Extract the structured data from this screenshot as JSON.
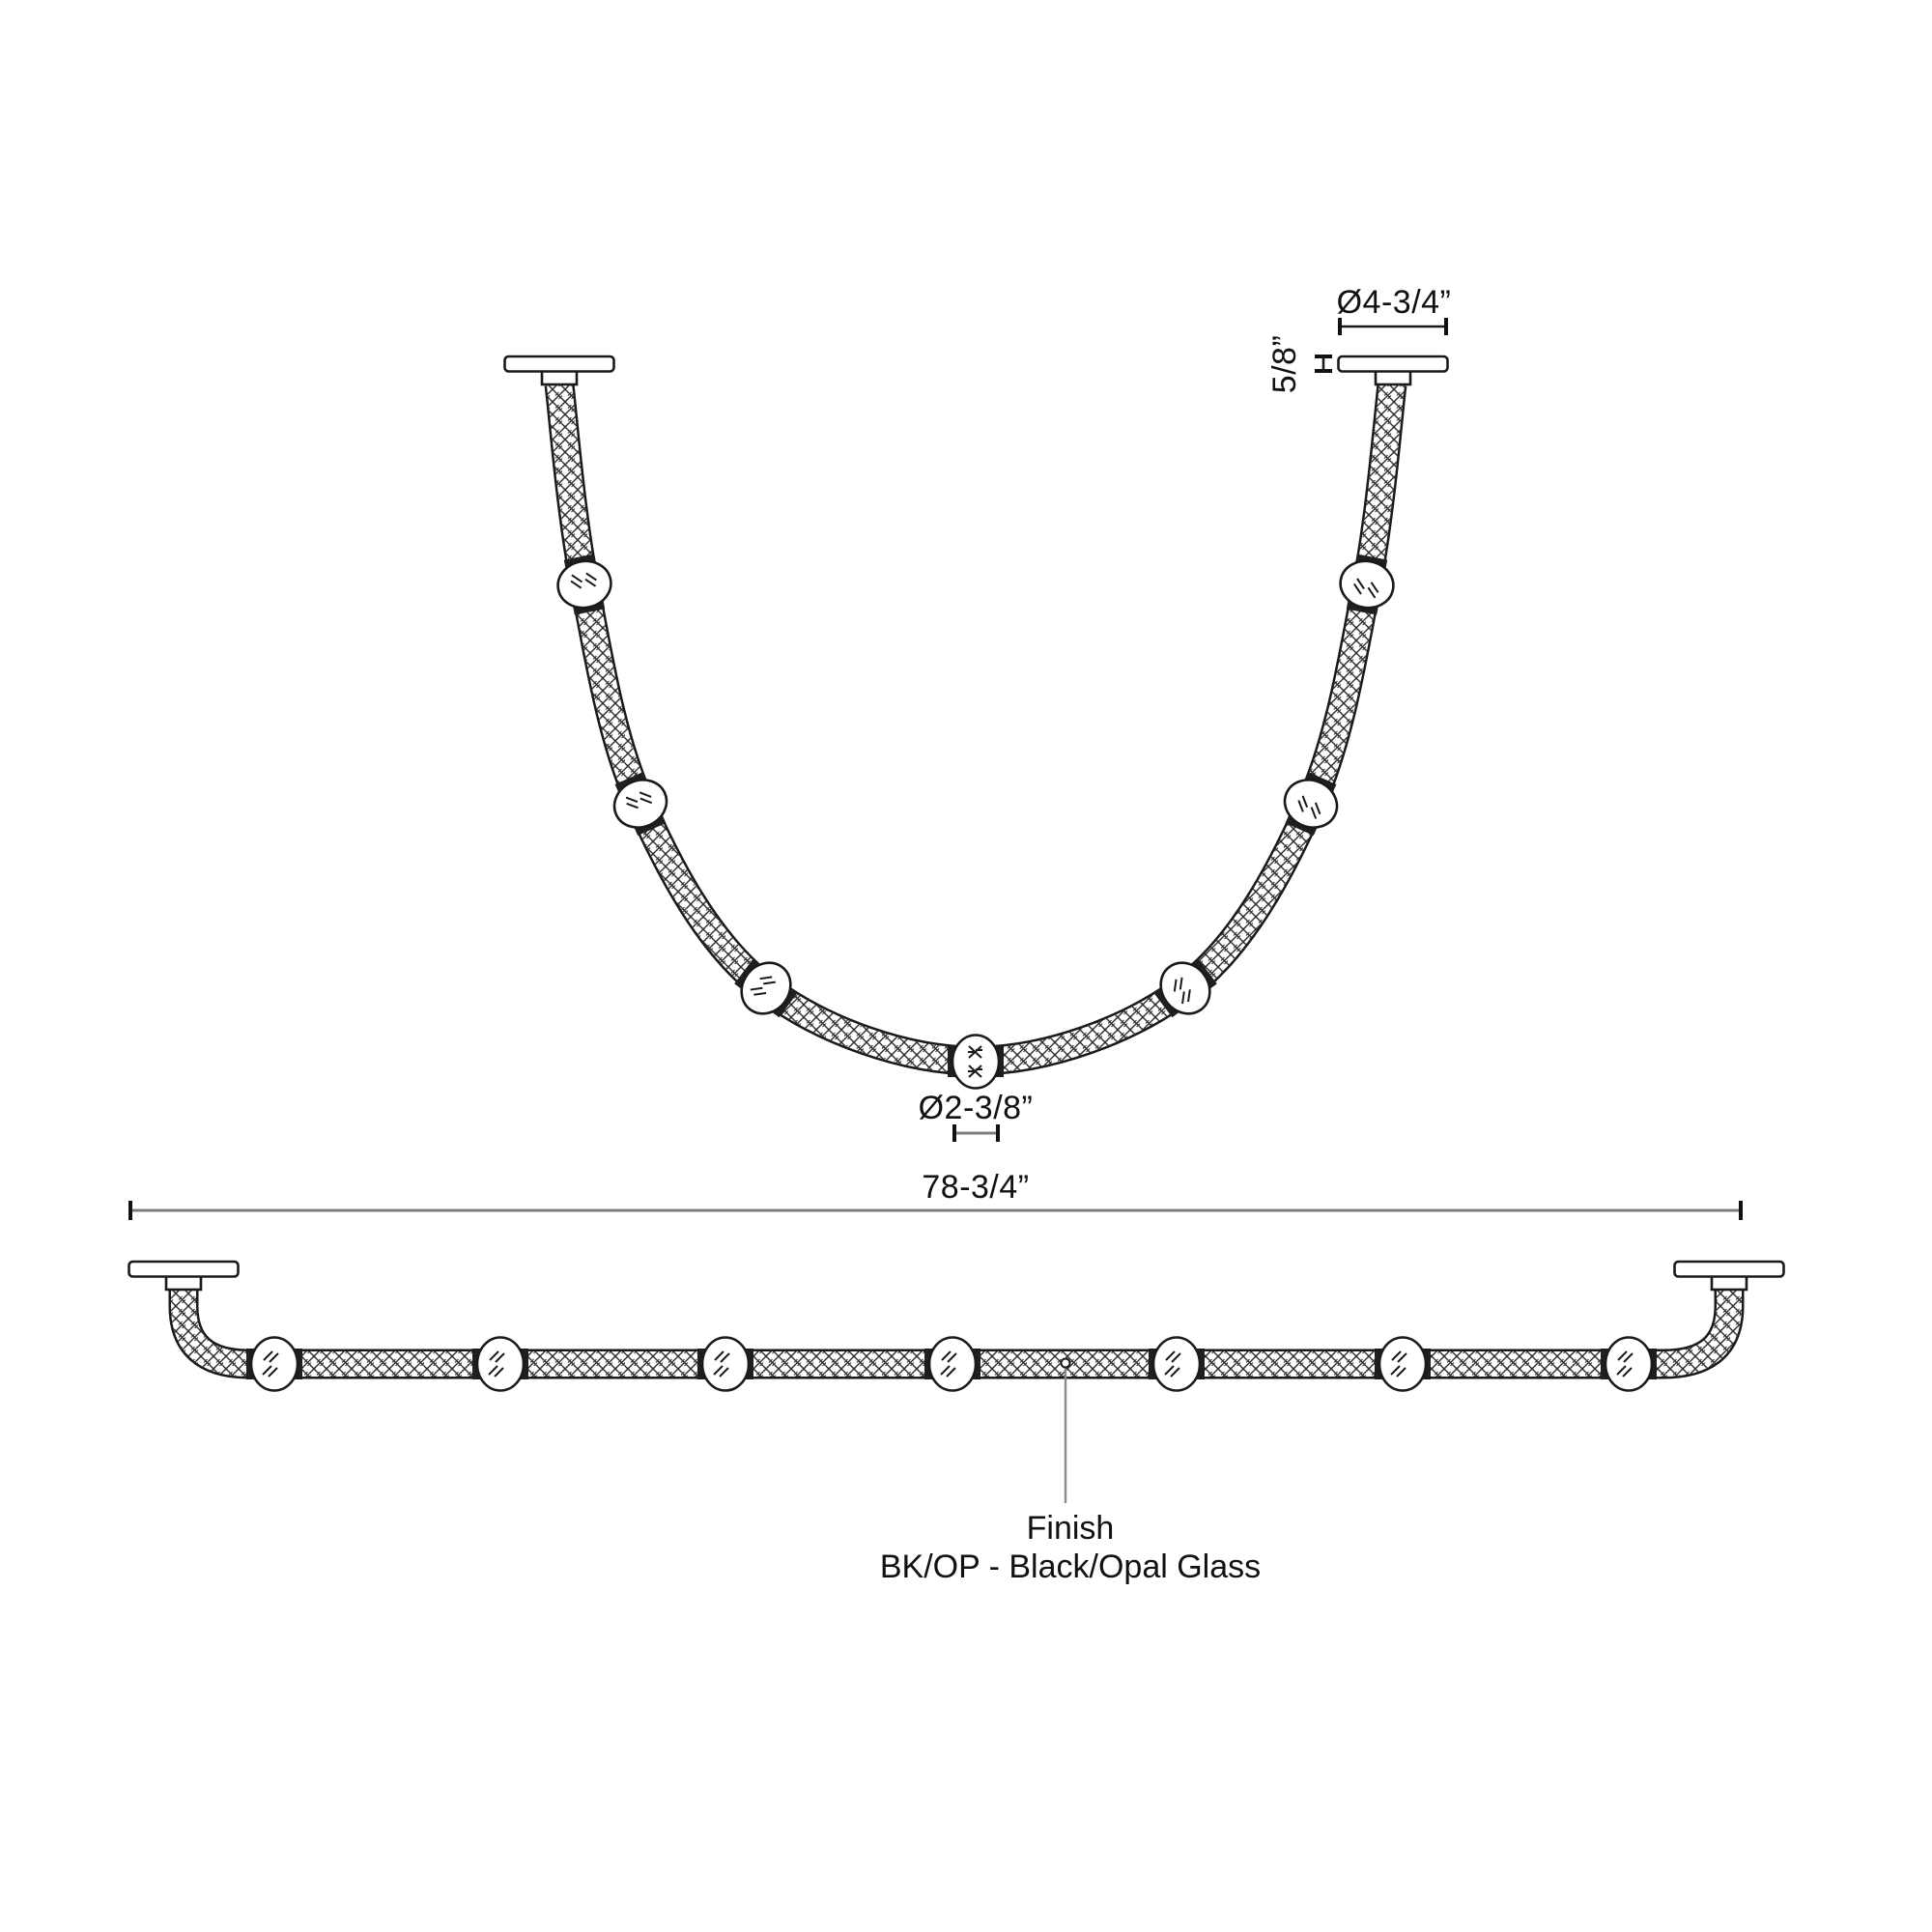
{
  "drawing": {
    "type": "lighting-fixture-dimension-drawing",
    "views": {
      "suspended_view": "draped cord pendant with 7 glass orbs",
      "straight_view": "straightened cord with 7 glass orbs"
    },
    "dimensions": {
      "canopy_diameter": "Ø4-3/4”",
      "canopy_height": "5/8”",
      "orb_diameter": "Ø2-3/8”",
      "overall_length": "78-3/4”"
    },
    "finish": {
      "label": "Finish",
      "value": "BK/OP - Black/Opal Glass"
    },
    "counts": {
      "orbs_per_view": 7
    },
    "colors": {
      "line": "#1a1a1a",
      "dim_line_gray": "#7d7d7d",
      "connector_band": "#1f1f1f",
      "background": "#ffffff"
    }
  }
}
